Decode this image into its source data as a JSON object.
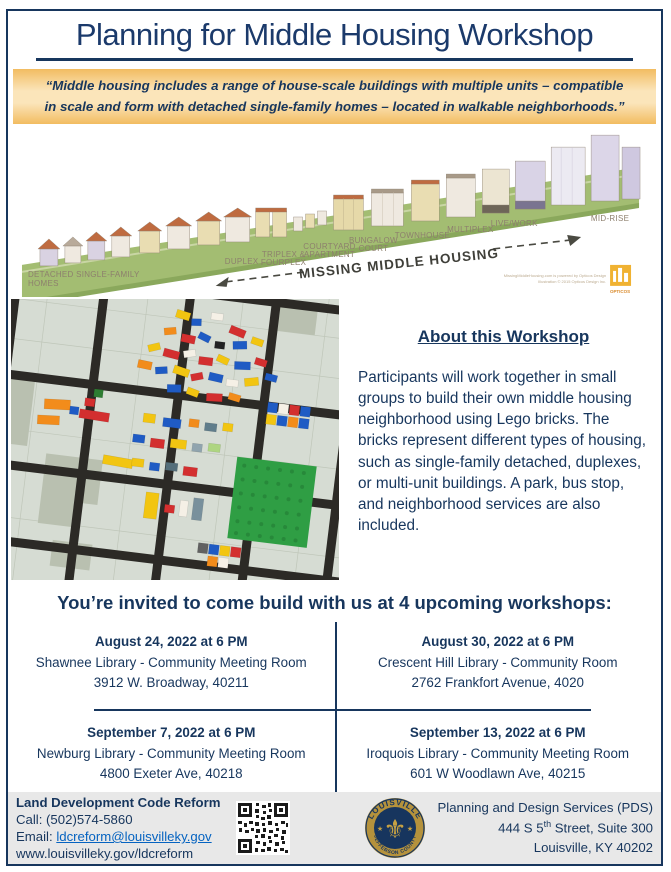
{
  "colors": {
    "accent_navy": "#17365d",
    "quote_bg_edge": "#f2bc61",
    "quote_bg_mid": "#fbe5ba",
    "footer_bg": "#e8e8e8",
    "link_blue": "#0563c1",
    "logo_gold": "#b5923c",
    "logo_navy": "#17355e"
  },
  "header": {
    "title": "Planning for Middle Housing Workshop"
  },
  "quote": {
    "text": "“Middle housing includes a range of house-scale buildings with multiple units – compatible in scale and form with detached single-family homes – located in walkable neighborhoods.”"
  },
  "illustration": {
    "labels": {
      "detached_line1": "DETACHED SINGLE-FAMILY",
      "detached_line2": "HOMES",
      "duplex": "DUPLEX",
      "triplex_line1": "TRIPLEX &",
      "triplex_line2": "FOURPLEX",
      "courtyard_line1": "COURTYARD",
      "courtyard_line2": "APARTMENT",
      "bungalow_line1": "BUNGALOW",
      "bungalow_line2": "COURT",
      "townhouse": "TOWNHOUSE",
      "multiplex": "MULTIPLEX",
      "livework": "LIVE/WORK",
      "midrise": "MID-RISE",
      "banner": "MISSING MIDDLE HOUSING",
      "credit_line1": "MissingMiddleHousing.com is powered by Opticos Design",
      "credit_line2": "Illustration © 2015 Opticos Design Inc.",
      "opticos_logo_text": "OPTICOS"
    }
  },
  "about": {
    "heading": "About this Workshop",
    "body": "Participants will work together in small groups to build their own middle housing neighborhood using Lego bricks. The bricks represent different types of housing, such as single-family detached, duplexes, or multi-unit buildings. A park, bus stop, and neighborhood services are also included."
  },
  "workshops": {
    "heading": "You’re invited to come build with us at 4 upcoming workshops:",
    "events": [
      {
        "datetime": "August 24, 2022 at 6 PM",
        "venue": "Shawnee Library - Community Meeting Room",
        "address": "3912 W. Broadway, 40211"
      },
      {
        "datetime": "August 30, 2022 at 6 PM",
        "venue": "Crescent Hill Library - Community Room",
        "address": "2762 Frankfort Avenue, 4020"
      },
      {
        "datetime": "September 7, 2022 at 6 PM",
        "venue": "Newburg Library - Community Meeting Room",
        "address": "4800 Exeter Ave, 40218"
      },
      {
        "datetime": "September 13, 2022 at 6 PM",
        "venue": "Iroquois Library - Community Meeting Room",
        "address": "601 W Woodlawn Ave, 40215"
      }
    ]
  },
  "footer": {
    "left": {
      "title": "Land Development Code Reform",
      "call_line": "Call: (502)574-5860",
      "email_label": "Email: ",
      "email": "ldcreform@louisvilleky.gov",
      "website": "www.louisvilleky.gov/ldcreform"
    },
    "icons": {
      "qr_code": "qr-code",
      "seal": "louisville-jefferson-county-seal"
    },
    "logo": {
      "arc_top": "LOUISVILLE",
      "arc_bottom": "JEFFERSON COUNTY",
      "fleur": "⚜",
      "star": "★"
    },
    "right": {
      "org": "Planning and Design Services (PDS)",
      "address_pre": "444 S 5",
      "address_sup": "th",
      "address_post": " Street, Suite 300",
      "city": "Louisville, KY 40202"
    }
  }
}
